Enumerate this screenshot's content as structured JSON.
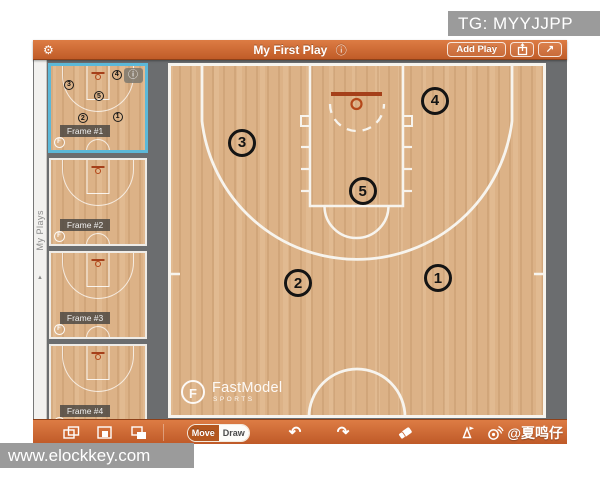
{
  "overlays": {
    "tg_badge": "TG: MYYJJPP",
    "site_badge": "www.elockkey.com",
    "weibo_credit": "@夏鸣仔"
  },
  "titlebar": {
    "title": "My First Play",
    "info_glyph": "ⓘ",
    "gear_glyph": "⚙",
    "add_play_label": "Add Play",
    "expand_glyph": "↗"
  },
  "sidebar": {
    "tab_label": "My Plays",
    "tab_arrow": "▲",
    "frames": [
      {
        "label": "Frame #1",
        "selected": true,
        "has_players": true,
        "has_info": true
      },
      {
        "label": "Frame #2",
        "selected": false,
        "has_players": false,
        "has_info": false
      },
      {
        "label": "Frame #3",
        "selected": false,
        "has_players": false,
        "has_info": false
      },
      {
        "label": "Frame #4",
        "selected": false,
        "has_players": false,
        "has_info": false
      }
    ]
  },
  "court": {
    "players": [
      {
        "number": "1",
        "x": 71.4,
        "y": 60.6
      },
      {
        "number": "2",
        "x": 34.4,
        "y": 62.0
      },
      {
        "number": "3",
        "x": 19.6,
        "y": 22.5
      },
      {
        "number": "4",
        "x": 70.6,
        "y": 10.7
      },
      {
        "number": "5",
        "x": 51.5,
        "y": 36.1
      }
    ],
    "watermark": {
      "initial": "F",
      "brand": "FastModel",
      "sub": "SPORTS"
    }
  },
  "toolbar": {
    "move_label": "Move",
    "draw_label": "Draw",
    "active_mode": "Draw",
    "undo_glyph": "↶",
    "redo_glyph": "↷"
  },
  "colors": {
    "accent_orange": "#c96330",
    "selection_blue": "#5cb8d8",
    "court_wood": "#dcb287",
    "line_white": "#f7f4ee",
    "backboard_red": "#a5401a",
    "canvas_gray": "#6b6d6f"
  }
}
